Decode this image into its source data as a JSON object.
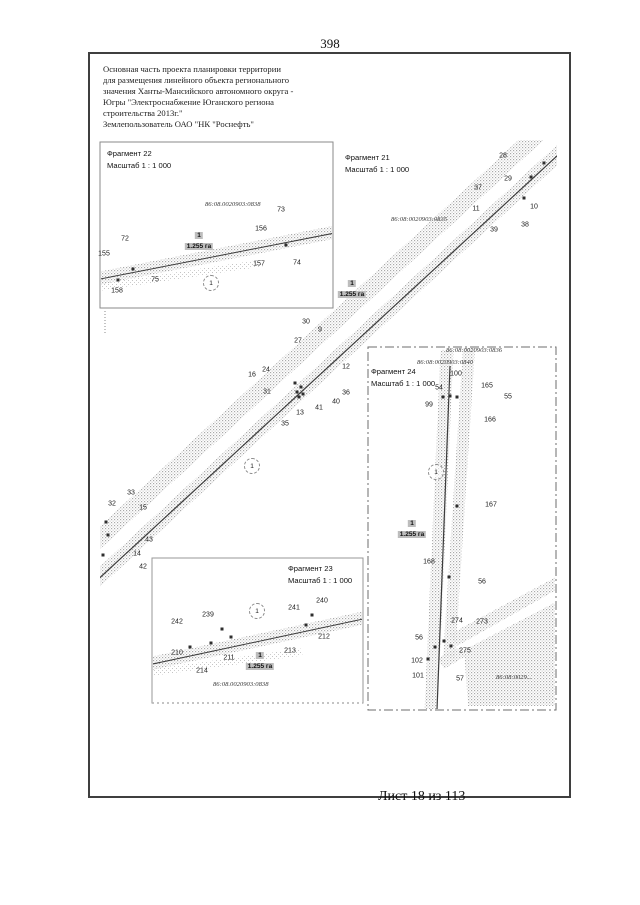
{
  "page": {
    "number": "398",
    "footer": "Лист 18 из 113"
  },
  "header": {
    "lines": [
      "Основная часть проекта планировки территории",
      "для размещения линейного объекта регионального",
      "значения Ханты-Мансийского автономного округа -",
      "Югры \"Электроснабжение Юганского региона",
      "строительства 2013г.\"",
      "Землепользователь ОАО \"НК \"Роснефть\""
    ]
  },
  "fragments": {
    "f22": {
      "title": "Фрагмент 22",
      "scale": "Масштаб 1 : 1 000"
    },
    "f21": {
      "title": "Фрагмент 21",
      "scale": "Масштаб 1 : 1 000"
    },
    "f23": {
      "title": "Фрагмент 23",
      "scale": "Масштаб 1 : 1 000"
    },
    "f24": {
      "title": "Фрагмент 24",
      "scale": "Масштаб 1 : 1 000"
    }
  },
  "cadastral": {
    "f22": "86:08.0020903:0838",
    "f21": "86:08:0020903:0835",
    "f23": "86:08.0020903:0838",
    "f24_top": "86:08:0020903:0836",
    "f24_mid": "86:08:0020903:0840",
    "f24_bottom": "86:08:0029..."
  },
  "area_labels": [
    {
      "x": 199,
      "y": 224,
      "no": "1",
      "value": "1.255 га"
    },
    {
      "x": 352,
      "y": 272,
      "no": "1",
      "value": "1.255 га"
    },
    {
      "x": 260,
      "y": 644,
      "no": "1",
      "value": "1.255 га"
    },
    {
      "x": 412,
      "y": 512,
      "no": "1",
      "value": "1.255 га"
    }
  ],
  "circles": [
    {
      "x": 211,
      "y": 283,
      "t": "1"
    },
    {
      "x": 252,
      "y": 466,
      "t": "1"
    },
    {
      "x": 257,
      "y": 611,
      "t": "1"
    },
    {
      "x": 436,
      "y": 472,
      "t": "1"
    }
  ],
  "points": [
    {
      "x": 125,
      "y": 239,
      "t": "72"
    },
    {
      "x": 104,
      "y": 254,
      "t": "155"
    },
    {
      "x": 155,
      "y": 280,
      "t": "75"
    },
    {
      "x": 117,
      "y": 291,
      "t": "158"
    },
    {
      "x": 281,
      "y": 210,
      "t": "73"
    },
    {
      "x": 261,
      "y": 229,
      "t": "156"
    },
    {
      "x": 259,
      "y": 264,
      "t": "157"
    },
    {
      "x": 297,
      "y": 263,
      "t": "74"
    },
    {
      "x": 503,
      "y": 156,
      "t": "28"
    },
    {
      "x": 508,
      "y": 179,
      "t": "29"
    },
    {
      "x": 478,
      "y": 188,
      "t": "37"
    },
    {
      "x": 476,
      "y": 209,
      "t": "11"
    },
    {
      "x": 534,
      "y": 207,
      "t": "10"
    },
    {
      "x": 525,
      "y": 225,
      "t": "38"
    },
    {
      "x": 494,
      "y": 230,
      "t": "39"
    },
    {
      "x": 306,
      "y": 322,
      "t": "30"
    },
    {
      "x": 320,
      "y": 330,
      "t": "9"
    },
    {
      "x": 298,
      "y": 341,
      "t": "27"
    },
    {
      "x": 346,
      "y": 367,
      "t": "12"
    },
    {
      "x": 266,
      "y": 370,
      "t": "24"
    },
    {
      "x": 252,
      "y": 375,
      "t": "16"
    },
    {
      "x": 267,
      "y": 392,
      "t": "31"
    },
    {
      "x": 346,
      "y": 393,
      "t": "36"
    },
    {
      "x": 336,
      "y": 402,
      "t": "40"
    },
    {
      "x": 319,
      "y": 408,
      "t": "41"
    },
    {
      "x": 300,
      "y": 413,
      "t": "13"
    },
    {
      "x": 285,
      "y": 424,
      "t": "35"
    },
    {
      "x": 131,
      "y": 493,
      "t": "33"
    },
    {
      "x": 112,
      "y": 504,
      "t": "32"
    },
    {
      "x": 143,
      "y": 508,
      "t": "15"
    },
    {
      "x": 149,
      "y": 540,
      "t": "43"
    },
    {
      "x": 137,
      "y": 554,
      "t": "14"
    },
    {
      "x": 143,
      "y": 567,
      "t": "42"
    },
    {
      "x": 208,
      "y": 615,
      "t": "239"
    },
    {
      "x": 177,
      "y": 622,
      "t": "242"
    },
    {
      "x": 322,
      "y": 601,
      "t": "240"
    },
    {
      "x": 294,
      "y": 608,
      "t": "241"
    },
    {
      "x": 177,
      "y": 653,
      "t": "210"
    },
    {
      "x": 229,
      "y": 658,
      "t": "211"
    },
    {
      "x": 202,
      "y": 671,
      "t": "214"
    },
    {
      "x": 290,
      "y": 651,
      "t": "213"
    },
    {
      "x": 324,
      "y": 637,
      "t": "212"
    },
    {
      "x": 456,
      "y": 374,
      "t": "100"
    },
    {
      "x": 439,
      "y": 388,
      "t": "54"
    },
    {
      "x": 429,
      "y": 405,
      "t": "99"
    },
    {
      "x": 487,
      "y": 386,
      "t": "165"
    },
    {
      "x": 508,
      "y": 397,
      "t": "55"
    },
    {
      "x": 490,
      "y": 420,
      "t": "166"
    },
    {
      "x": 491,
      "y": 505,
      "t": "167"
    },
    {
      "x": 429,
      "y": 562,
      "t": "168"
    },
    {
      "x": 482,
      "y": 582,
      "t": "56"
    },
    {
      "x": 482,
      "y": 622,
      "t": "273"
    },
    {
      "x": 457,
      "y": 621,
      "t": "274"
    },
    {
      "x": 419,
      "y": 638,
      "t": "56"
    },
    {
      "x": 465,
      "y": 651,
      "t": "275"
    },
    {
      "x": 417,
      "y": 661,
      "t": "102"
    },
    {
      "x": 418,
      "y": 676,
      "t": "101"
    },
    {
      "x": 460,
      "y": 679,
      "t": "57"
    }
  ],
  "markers": [
    {
      "x": 133,
      "y": 269
    },
    {
      "x": 286,
      "y": 245
    },
    {
      "x": 118,
      "y": 280
    },
    {
      "x": 544,
      "y": 163
    },
    {
      "x": 531,
      "y": 177
    },
    {
      "x": 524,
      "y": 198
    },
    {
      "x": 295,
      "y": 383
    },
    {
      "x": 301,
      "y": 387
    },
    {
      "x": 297,
      "y": 392
    },
    {
      "x": 303,
      "y": 394
    },
    {
      "x": 299,
      "y": 397
    },
    {
      "x": 106,
      "y": 522
    },
    {
      "x": 108,
      "y": 535
    },
    {
      "x": 103,
      "y": 555
    },
    {
      "x": 222,
      "y": 629
    },
    {
      "x": 231,
      "y": 637
    },
    {
      "x": 211,
      "y": 643
    },
    {
      "x": 312,
      "y": 615
    },
    {
      "x": 306,
      "y": 625
    },
    {
      "x": 190,
      "y": 647
    },
    {
      "x": 443,
      "y": 397
    },
    {
      "x": 450,
      "y": 396
    },
    {
      "x": 457,
      "y": 397
    },
    {
      "x": 457,
      "y": 506
    },
    {
      "x": 449,
      "y": 577
    },
    {
      "x": 435,
      "y": 647
    },
    {
      "x": 444,
      "y": 641
    },
    {
      "x": 428,
      "y": 659
    },
    {
      "x": 451,
      "y": 646
    }
  ]
}
